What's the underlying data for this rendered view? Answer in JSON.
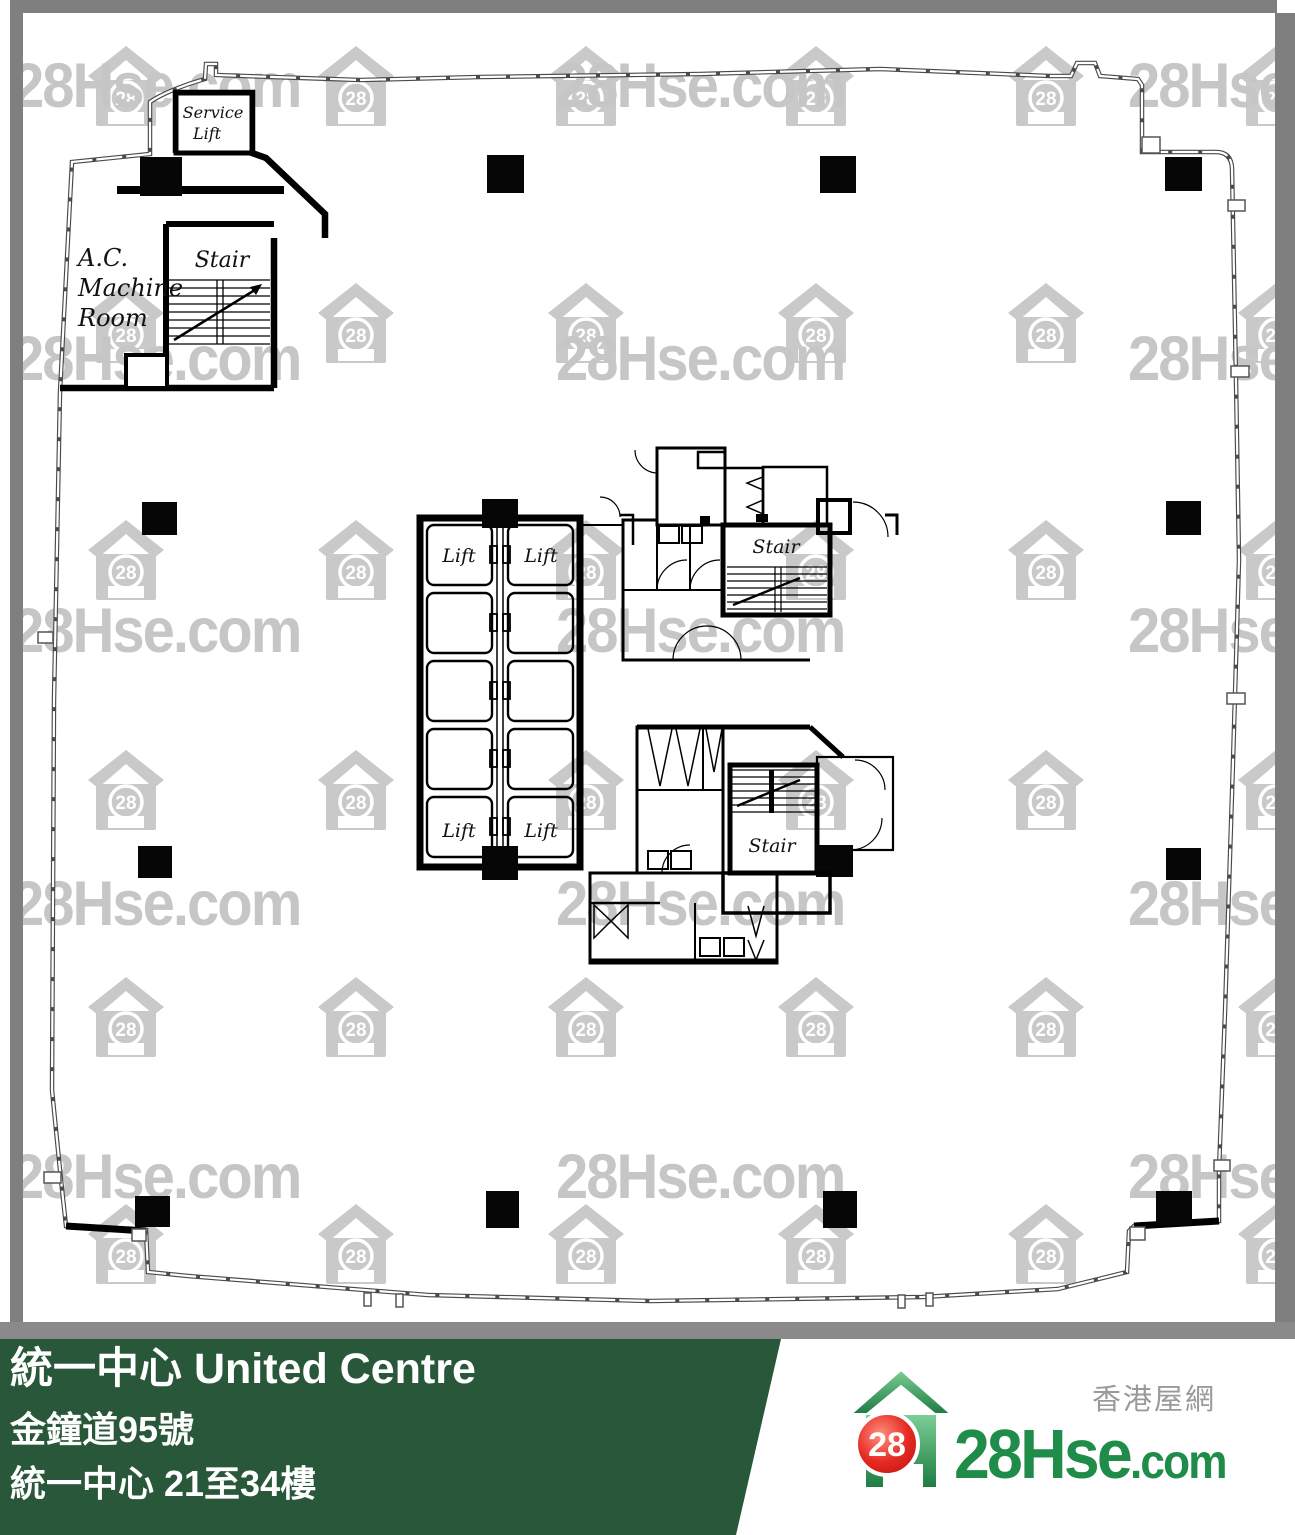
{
  "watermark": {
    "text": "28Hse.com",
    "badge": "28",
    "house_rows_y": [
      46,
      283,
      520,
      750,
      977,
      1204
    ],
    "house_cols_x": [
      88,
      318,
      548,
      778,
      1008,
      1238
    ],
    "text_rows_y": [
      50,
      323,
      595,
      868,
      1141
    ],
    "text_cols_x": [
      12,
      556,
      1128
    ]
  },
  "plan": {
    "rooms": {
      "service_lift_line1": "Service",
      "service_lift_line2": "Lift",
      "ac_line1": "A.C.",
      "ac_line2": "Machine",
      "ac_line3": "Room",
      "stair_top_left": "Stair",
      "stair_upper": "Stair",
      "stair_lower": "Stair",
      "lift_top_left": "Lift",
      "lift_top_right": "Lift",
      "lift_bottom_left": "Lift",
      "lift_bottom_right": "Lift"
    }
  },
  "footer": {
    "title": "統一中心 United Centre",
    "address": "金鐘道95號",
    "floors": "統一中心 21至34樓",
    "site_name": "香港屋網",
    "logo": {
      "badge": "28",
      "name": "28Hse",
      "tld": ".com"
    },
    "colors": {
      "bar_green": "#28573A",
      "strip_gray": "#8a8a8a",
      "logo_green": "#1f8c49",
      "logo_red": "#e32222",
      "watermark_gray": "#c6c6c6"
    }
  }
}
